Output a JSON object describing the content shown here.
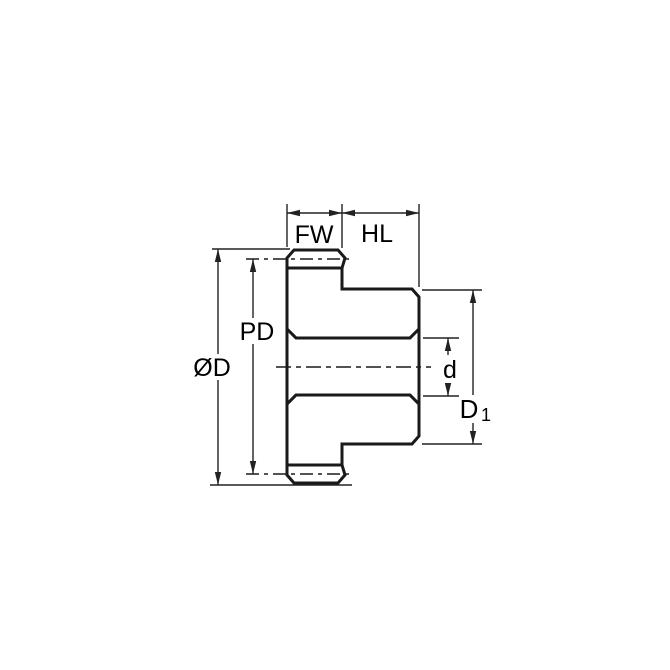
{
  "diagram": {
    "labels": {
      "face_width": "FW",
      "hub_length": "HL",
      "pitch_diameter": "PD",
      "outside_diameter": "ØD",
      "bore_diameter": "d",
      "hub_diameter_base": "D",
      "hub_diameter_subscript": "1"
    },
    "colors": {
      "part_fill": "#c9e8f8",
      "outline": "#1a1a1a",
      "dimension_lines": "#222222",
      "background": "#ffffff"
    }
  }
}
